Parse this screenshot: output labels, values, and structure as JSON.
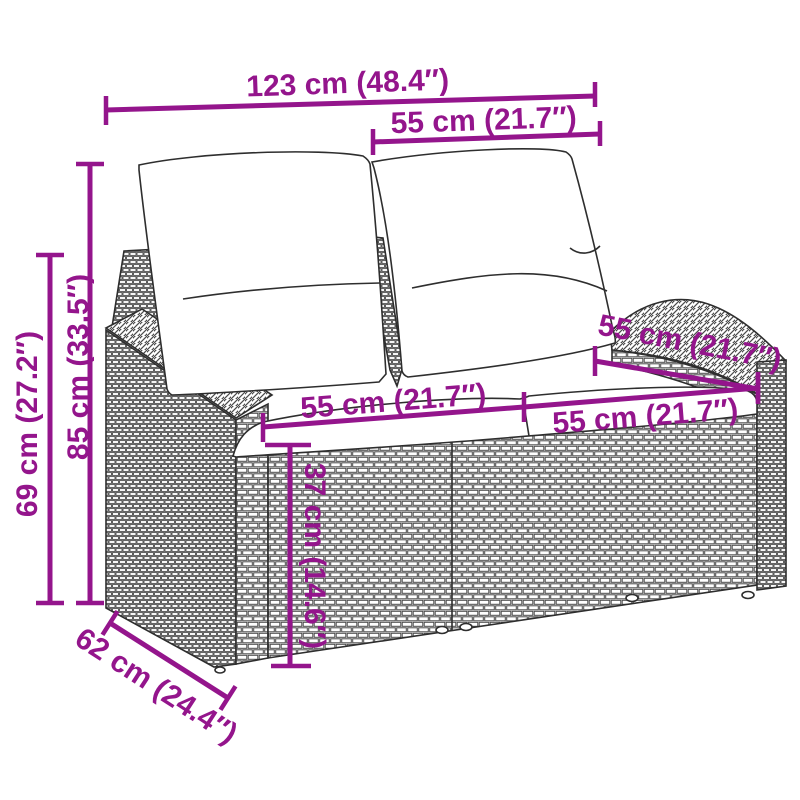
{
  "accent_color": "#94158C",
  "drawing": {
    "subject": "poly rattan two-seater garden bench with back and seat cushions",
    "style": "black line drawing with wicker weave texture",
    "line_color": "#2e2e2e"
  },
  "dimensions": {
    "overall_width": {
      "label": "123 cm (48.4″)"
    },
    "backrest_section_width": {
      "label": "55 cm (21.7″)"
    },
    "total_height": {
      "label": "85 cm (33.5″)"
    },
    "armrest_height": {
      "label": "69 cm (27.2″)"
    },
    "seat_depth": {
      "label": "55 cm (21.7″)"
    },
    "seat_width_left": {
      "label": "55 cm (21.7″)"
    },
    "seat_width_right": {
      "label": "55 cm (21.7″)"
    },
    "seat_height": {
      "label": "37 cm (14.6″)"
    },
    "overall_depth": {
      "label": "62 cm (24.4″)"
    }
  }
}
